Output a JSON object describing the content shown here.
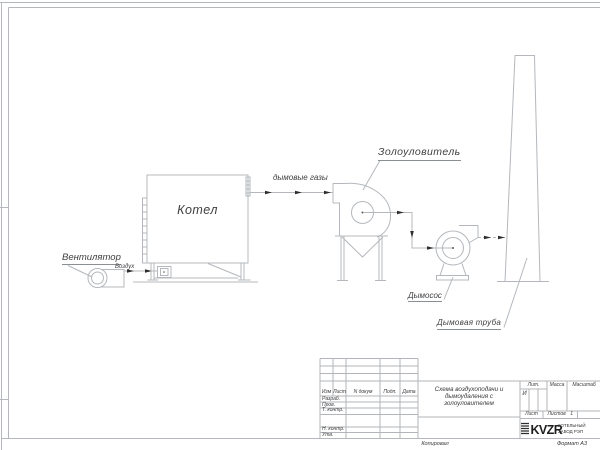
{
  "diagram": {
    "labels": {
      "fan": "Вентилятор",
      "air": "Воздух",
      "boiler": "Котел",
      "flue_gases": "дымовые газы",
      "ash_collector": "Золоуловитель",
      "smoke_exhauster": "Дымосос",
      "chimney": "Дымовая труба"
    }
  },
  "title_block": {
    "header_columns": {
      "izm": "Изм",
      "list": "Лист",
      "doc": "N докум",
      "podp": "Подп.",
      "data": "Дата"
    },
    "signature_rows": {
      "razrab": "Разраб.",
      "prov": "Пров.",
      "t_kontr": "Т. контр.",
      "n_kontr": "Н. контр.",
      "utv": "Утв."
    },
    "title_line1": "Схема воздухоподачи и",
    "title_line2": "дымоудаления с",
    "title_line3": "золоуловителем",
    "lit_header": "Лит.",
    "lit_value": "И",
    "mass_header": "Масса",
    "scale_header": "Масштаб",
    "sheet_label": "Лист",
    "sheets_label": "Листов",
    "sheets_value": "1",
    "logo_text": "KVZR",
    "company_line1": "КОТЕЛЬНЫЙ",
    "company_line2": "ЗАВОД РЭП"
  },
  "footer": {
    "copied": "Копировал",
    "format": "Формат А3"
  },
  "colors": {
    "line": "#b4b8bc",
    "text": "#3f3f3f",
    "arrow": "#2e2e2e"
  }
}
